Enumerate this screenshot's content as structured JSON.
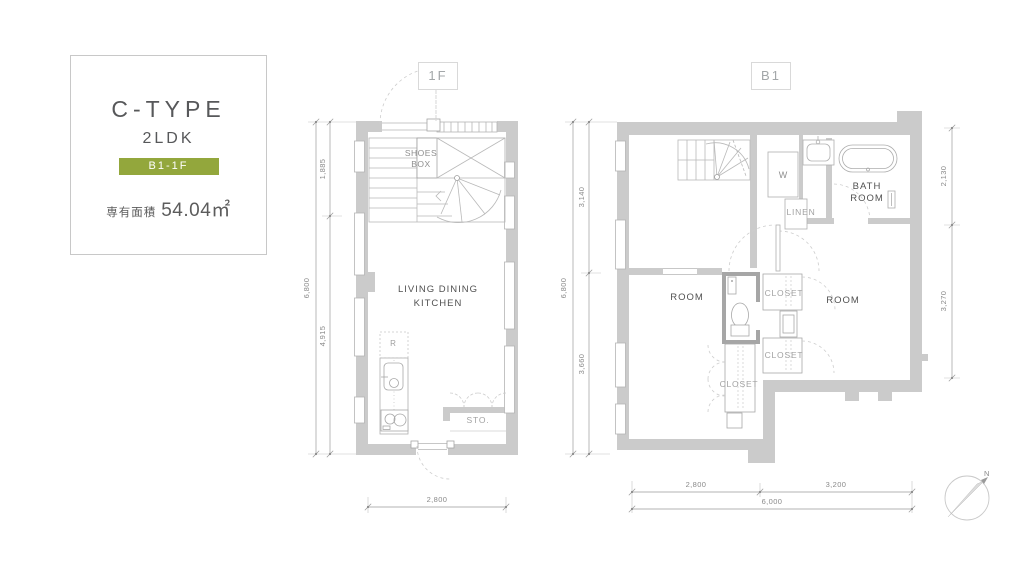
{
  "info_card": {
    "type_name": "C-TYPE",
    "layout": "2LDK",
    "floor_badge": "B1-1F",
    "area_label": "専有面積",
    "area_value": "54.04㎡"
  },
  "floor_1f": {
    "label": "1F",
    "labels": {
      "shoes_box": "SHOES\nBOX",
      "living_dining_kitchen": "LIVING DINING\nKITCHEN",
      "storage": "STO.",
      "refrigerator": "R"
    },
    "dimensions": {
      "total_height": "6,800",
      "upper_height": "1,885",
      "lower_height": "4,915",
      "width": "2,800"
    }
  },
  "floor_b1": {
    "label": "B1",
    "labels": {
      "room_left": "ROOM",
      "room_right": "ROOM",
      "closet_right_top": "CLOSET",
      "closet_right_bottom": "CLOSET",
      "closet_left": "CLOSET",
      "linen": "LINEN",
      "washer": "W",
      "bath_room": "BATH\nROOM"
    },
    "dimensions": {
      "total_height": "6,800",
      "upper_height": "3,140",
      "lower_height": "3,660",
      "right_upper": "2,130",
      "right_lower": "3,270",
      "bottom_left": "2,800",
      "bottom_right": "3,200",
      "bottom_total": "6,000"
    }
  },
  "compass": {
    "north_label": "N"
  },
  "colors": {
    "badge_green": "#93a73c",
    "wall_gray": "#cbcbcb",
    "line_gray": "#b0b0b0",
    "dim_gray": "#8a8a8a"
  }
}
